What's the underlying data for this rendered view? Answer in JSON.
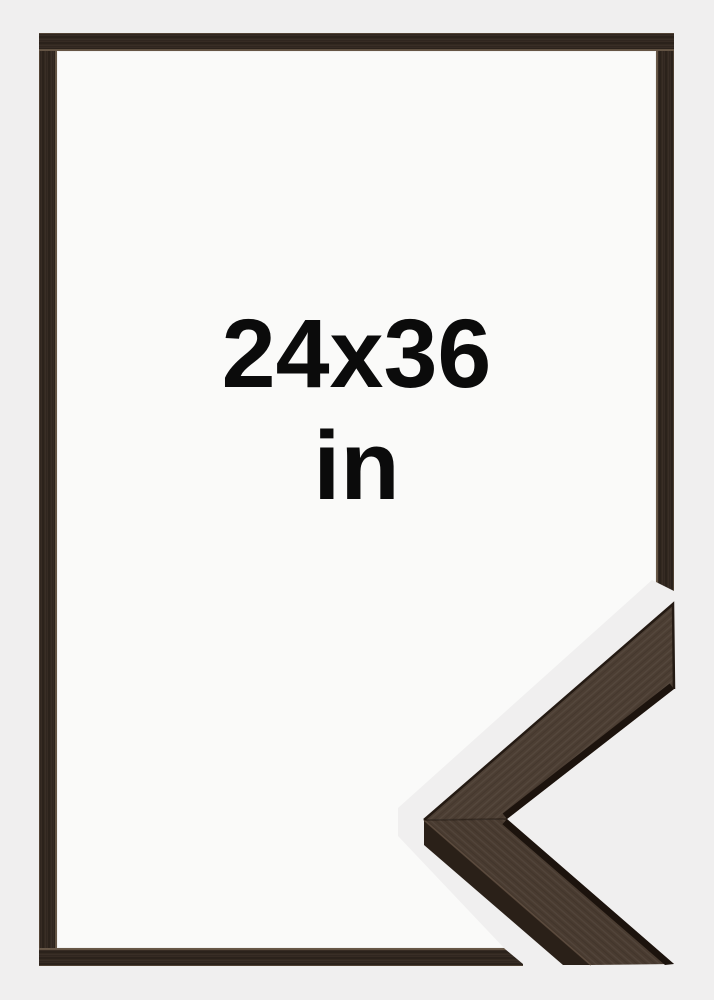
{
  "product_image": {
    "description": "picture frame product photo, dark walnut wood, front view with corner close-up",
    "size_label": "24x36",
    "unit_label": "in"
  },
  "frame": {
    "material": "dark walnut wood",
    "view": "front",
    "detail_view": "mitered corner close-up overlapping bottom-right"
  },
  "colors": {
    "page_bg": "#f0efef",
    "frame_interior": "#fafaf9",
    "frame_wood": "#342a22",
    "wood_face": "#4c3e33",
    "wood_face_lower": "#493b30",
    "wood_side": "#2a2018",
    "wood_shadow": "#1c130d",
    "text": "#0b0b0b"
  }
}
